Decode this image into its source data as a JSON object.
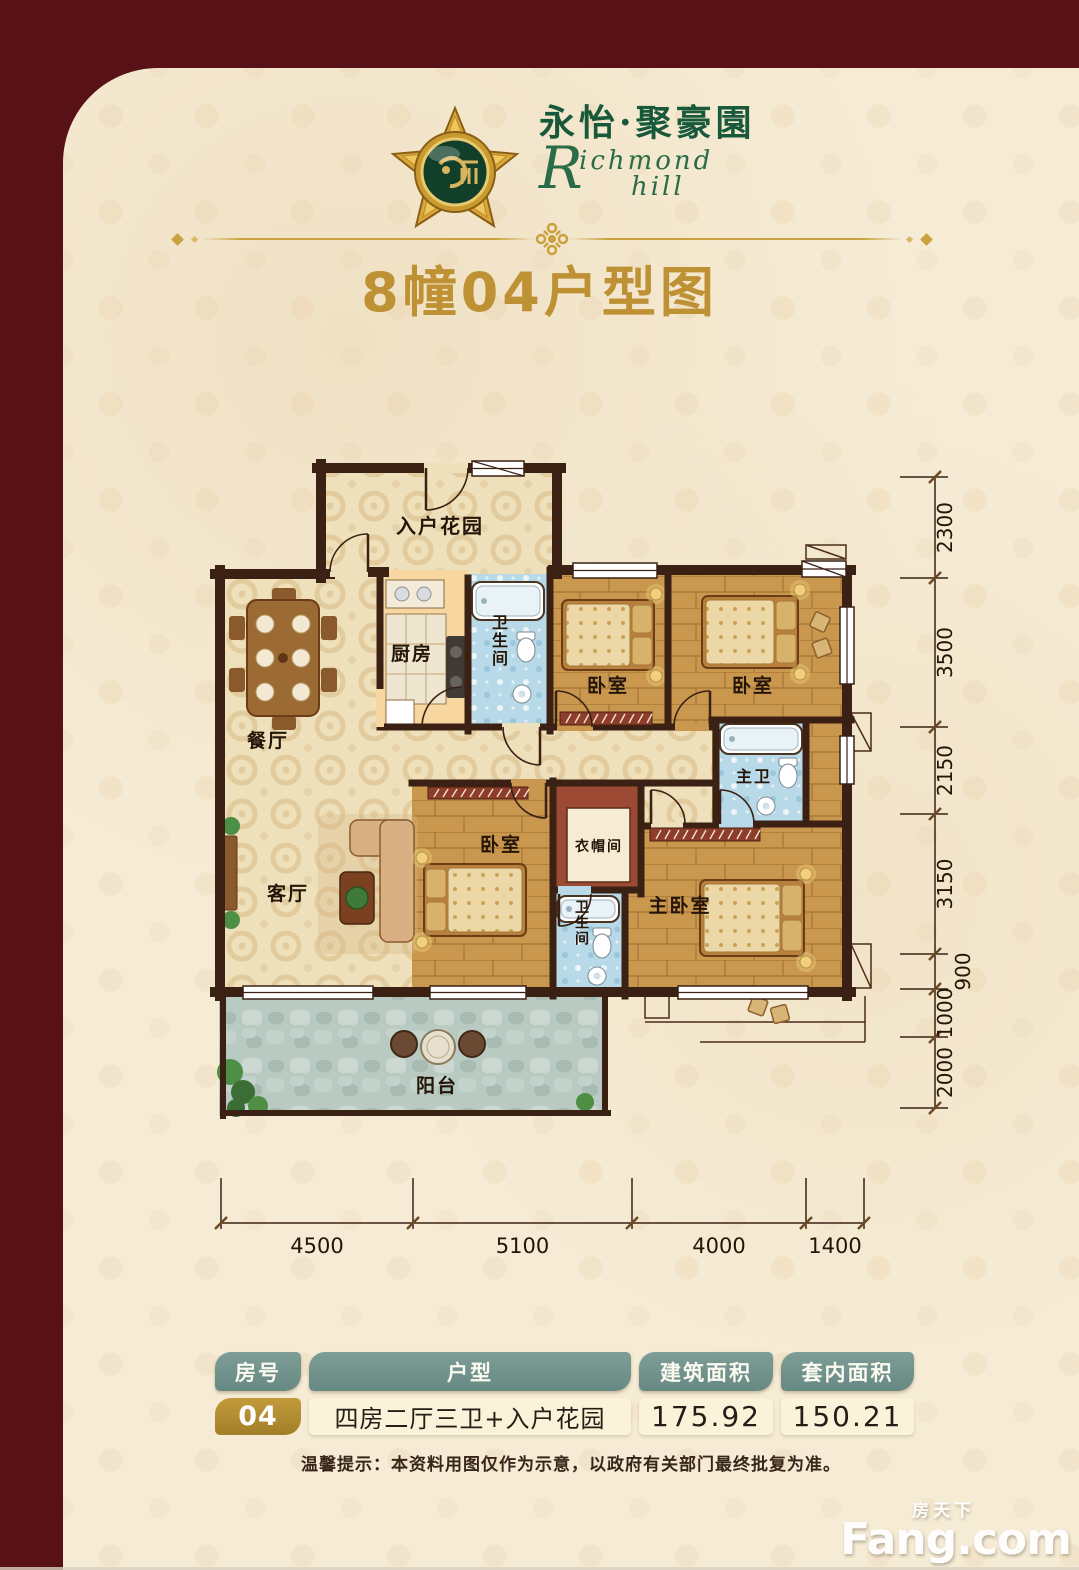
{
  "brand": {
    "name_cn": "永怡·聚豪園",
    "en_initial": "R",
    "en_part1": "ichmond",
    "en_part2": "hill"
  },
  "title": "8幢04户型图",
  "floor_plan": {
    "rooms": [
      {
        "key": "entry-garden",
        "label": "入户花园",
        "x": 440,
        "y": 533,
        "size": 20,
        "vertical": false
      },
      {
        "key": "kitchen",
        "label": "厨房",
        "x": 412,
        "y": 660,
        "size": 19,
        "vertical": false
      },
      {
        "key": "bath-1",
        "label": "卫生间",
        "x": 500,
        "y": 628,
        "size": 16,
        "vertical": true
      },
      {
        "key": "bedroom-1",
        "label": "卧室",
        "x": 608,
        "y": 692,
        "size": 19,
        "vertical": false
      },
      {
        "key": "bedroom-2",
        "label": "卧室",
        "x": 753,
        "y": 692,
        "size": 19,
        "vertical": false
      },
      {
        "key": "dining-room",
        "label": "餐厅",
        "x": 268,
        "y": 747,
        "size": 19,
        "vertical": false
      },
      {
        "key": "master-bath",
        "label": "主卫",
        "x": 754,
        "y": 782,
        "size": 16,
        "vertical": false
      },
      {
        "key": "bedroom-3",
        "label": "卧室",
        "x": 501,
        "y": 851,
        "size": 19,
        "vertical": false
      },
      {
        "key": "cloakroom",
        "label": "衣帽间",
        "x": 599,
        "y": 851,
        "size": 14,
        "vertical": false
      },
      {
        "key": "living-room",
        "label": "客厅",
        "x": 288,
        "y": 900,
        "size": 19,
        "vertical": false
      },
      {
        "key": "bath-2",
        "label": "卫生间",
        "x": 582,
        "y": 912,
        "size": 14,
        "vertical": true
      },
      {
        "key": "master-bedroom",
        "label": "主卧室",
        "x": 680,
        "y": 912,
        "size": 19,
        "vertical": false
      },
      {
        "key": "balcony",
        "label": "阳台",
        "x": 437,
        "y": 1092,
        "size": 19,
        "vertical": false
      }
    ],
    "dims_right": [
      "2300",
      "3500",
      "2150",
      "3150",
      "900",
      "1000",
      "2000"
    ],
    "dims_bottom": [
      "4500",
      "5100",
      "4000",
      "1400"
    ]
  },
  "table": {
    "headers": [
      "房号",
      "户型",
      "建筑面积",
      "套内面积"
    ],
    "row": {
      "no": "04",
      "layout": "四房二厅三卫+入户花园",
      "gross_area": "175.92",
      "inner_area": "150.21"
    }
  },
  "note": "温馨提示：本资料用图仅作为示意，以政府有关部门最终批复为准。",
  "watermark": {
    "cn": "房天下",
    "en": "Fang.com"
  },
  "colors": {
    "frame": "#571117",
    "gold": "#bd9134",
    "green": "#17593a",
    "table_header": "#72938d",
    "table_no": "#b28d33",
    "wall": "#3a2113"
  }
}
